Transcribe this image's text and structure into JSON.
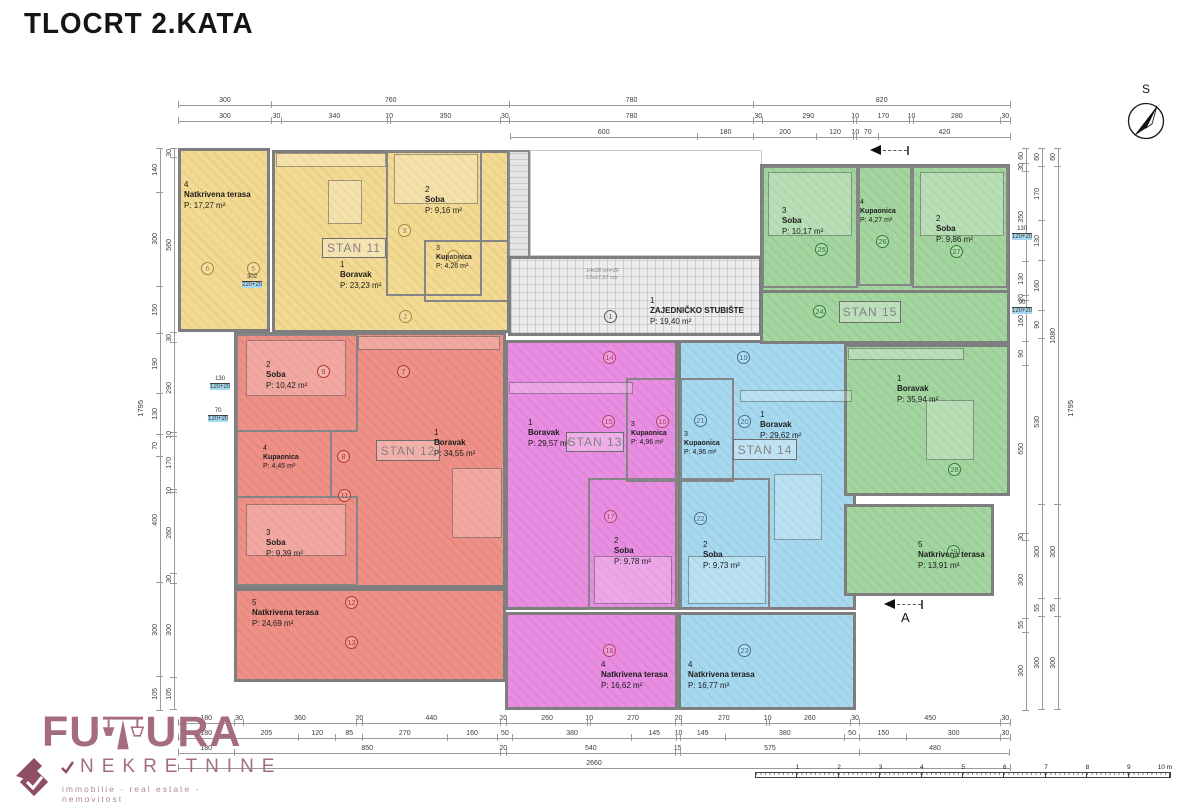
{
  "title": "TLOCRT 2.KATA",
  "compass": "S",
  "section_label": "A",
  "stairs": {
    "num": "1",
    "name": "ZAJEDNIČKO STUBIŠTE",
    "area": "P: 19,40 m²",
    "note1": "14x28 cm=2F",
    "note2": "17x17,57 cm"
  },
  "stan11": {
    "label": "STAN 11",
    "boravak": {
      "num": "1",
      "name": "Boravak",
      "area": "P: 23,23 m²"
    },
    "soba": {
      "num": "2",
      "name": "Soba",
      "area": "P: 9,16 m²"
    },
    "kupaonica": {
      "num": "3",
      "name": "Kupaonica",
      "area": "P: 4,26 m²"
    },
    "terasa": {
      "num": "4",
      "name": "Natkrivena terasa",
      "area": "P: 17,27 m²"
    }
  },
  "stan12": {
    "label": "STAN 12",
    "boravak": {
      "num": "1",
      "name": "Boravak",
      "area": "P: 34,55 m²"
    },
    "soba2": {
      "num": "2",
      "name": "Soba",
      "area": "P: 10,42 m²"
    },
    "soba3": {
      "num": "3",
      "name": "Soba",
      "area": "P: 9,39 m²"
    },
    "kupaonica": {
      "num": "4",
      "name": "Kupaonica",
      "area": "P: 4,45 m²"
    },
    "terasa": {
      "num": "5",
      "name": "Natkrivena terasa",
      "area": "P: 24,69 m²"
    }
  },
  "stan13": {
    "label": "STAN 13",
    "boravak": {
      "num": "1",
      "name": "Boravak",
      "area": "P: 29,57 m²"
    },
    "soba": {
      "num": "2",
      "name": "Soba",
      "area": "P: 9,78 m²"
    },
    "kupaonica": {
      "num": "3",
      "name": "Kupaonica",
      "area": "P: 4,96 m²"
    },
    "terasa": {
      "num": "4",
      "name": "Natkrivena terasa",
      "area": "P: 16,62 m²"
    }
  },
  "stan14": {
    "label": "STAN 14",
    "boravak": {
      "num": "1",
      "name": "Boravak",
      "area": "P: 29,62 m²"
    },
    "soba": {
      "num": "2",
      "name": "Soba",
      "area": "P: 9,73 m²"
    },
    "kupaonica": {
      "num": "3",
      "name": "Kupaonica",
      "area": "P: 4,96 m²"
    },
    "terasa": {
      "num": "4",
      "name": "Natkrivena terasa",
      "area": "P: 16,77 m²"
    }
  },
  "stan15": {
    "label": "STAN 15",
    "boravak": {
      "num": "1",
      "name": "Boravak",
      "area": "P: 35,94 m²"
    },
    "soba2": {
      "num": "2",
      "name": "Soba",
      "area": "P: 9,86 m²"
    },
    "soba3": {
      "num": "3",
      "name": "Soba",
      "area": "P: 10,17 m²"
    },
    "kupaonica": {
      "num": "4",
      "name": "Kupaonica",
      "area": "P: 4,27 m²"
    },
    "terasa": {
      "num": "5",
      "name": "Natkrivena terasa",
      "area": "P: 13,91 m²"
    }
  },
  "circles": {
    "c1": "1",
    "c2": "2",
    "c3": "3",
    "c4": "4",
    "c5": "5",
    "c6": "6",
    "c7": "7",
    "c8": "8",
    "c9": "9",
    "c11": "11",
    "c12": "12",
    "c13": "13",
    "c14": "14",
    "c15": "15",
    "c16": "16",
    "c17": "17",
    "c18": "18",
    "c19": "19",
    "c20": "20",
    "c21": "21",
    "c22": "22",
    "c23": "23",
    "c24": "24",
    "c25": "25",
    "c26": "26",
    "c27": "27",
    "c28": "28",
    "c29": "29"
  },
  "dims": {
    "top1": [
      "300",
      "760",
      "780",
      "820"
    ],
    "top2": [
      "300",
      "30",
      "340",
      "10",
      "350",
      "30",
      "780",
      "30",
      "290",
      "10",
      "170",
      "10",
      "280",
      "30"
    ],
    "top3": [
      "600",
      "180",
      "200",
      "120",
      "10",
      "70",
      "420"
    ],
    "bottom1": [
      "180",
      "30",
      "360",
      "20",
      "440",
      "20",
      "260",
      "10",
      "270",
      "20",
      "270",
      "10",
      "260",
      "30",
      "450",
      "30"
    ],
    "bottom2": [
      "180",
      "205",
      "120",
      "85",
      "270",
      "160",
      "50",
      "380",
      "145",
      "10",
      "145",
      "380",
      "50",
      "150",
      "300",
      "30"
    ],
    "bottom3": [
      "180",
      "850",
      "20",
      "540",
      "15",
      "575",
      "480"
    ],
    "bottom4": [
      "2660"
    ],
    "left_outer": [
      "140",
      "300",
      "150",
      "190",
      "130",
      "70",
      "400",
      "300",
      "105"
    ],
    "left_inner": [
      "30",
      "560",
      "30",
      "290",
      "10",
      "170",
      "10",
      "260",
      "30",
      "300",
      "105"
    ],
    "right1": [
      "60",
      "30",
      "350",
      "130",
      "20",
      "160",
      "90",
      "650",
      "30",
      "300",
      "55",
      "300"
    ],
    "right2": [
      "60",
      "170",
      "130",
      "160",
      "90",
      "530",
      "300",
      "55",
      "300"
    ],
    "right3": [
      "60",
      "1080",
      "300",
      "55",
      "300"
    ],
    "left_total": "1795",
    "right_total": "1795"
  },
  "sills": {
    "s1t": "130",
    "s1b": "120+20",
    "s2t": "70",
    "s2b": "120+20",
    "s3t": "130",
    "s3b": "120+20",
    "s4t": "90",
    "s4b": "120+20",
    "s5t": "302",
    "s5b": "220+20"
  },
  "scalebar": [
    "1",
    "2",
    "3",
    "4",
    "5",
    "6",
    "7",
    "8",
    "9",
    "10 m"
  ],
  "logo": {
    "part1": "FU",
    "part2": "URA",
    "name": "NEKRETNINE",
    "tagline": "immobilie - real estate - nemovitost"
  },
  "colors": {
    "stan11": "#f3da92",
    "stan12": "#ef9086",
    "stan13": "#e88de2",
    "stan14": "#a6d9ef",
    "stan15": "#a3d59f",
    "walls": "#7e7e7e",
    "logo": "#a56c80"
  }
}
